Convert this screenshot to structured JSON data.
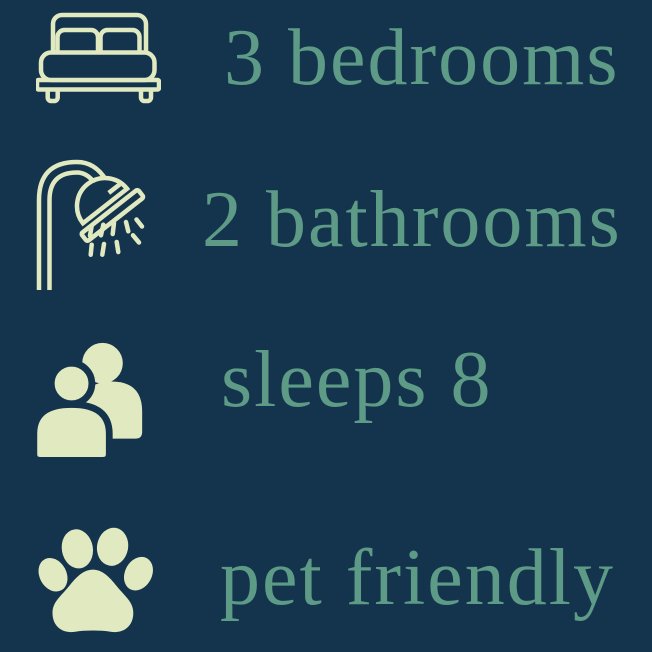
{
  "colors": {
    "background": "#14344e",
    "text": "#5d9b86",
    "icon": "#e1e9c0"
  },
  "features": [
    {
      "icon": "bed-icon",
      "label": "3 bedrooms"
    },
    {
      "icon": "shower-icon",
      "label": "2 bathrooms"
    },
    {
      "icon": "people-icon",
      "label": "sleeps 8"
    },
    {
      "icon": "paw-icon",
      "label": "pet friendly"
    }
  ]
}
